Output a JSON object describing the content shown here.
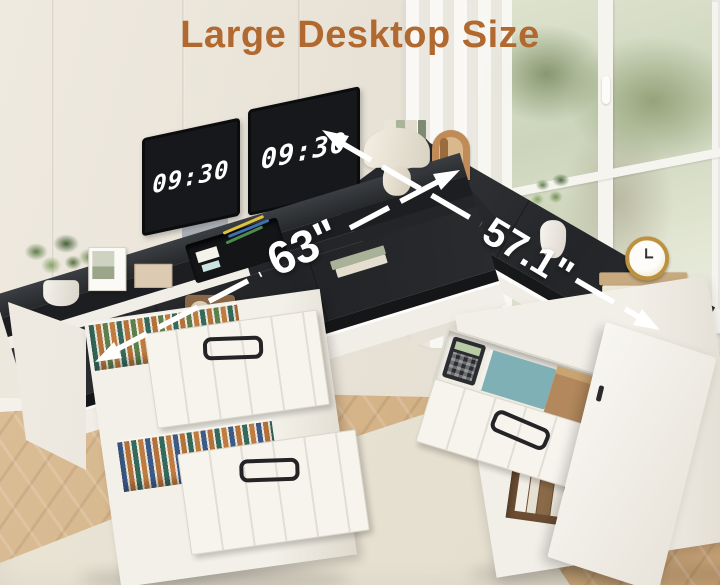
{
  "title": {
    "text": "Large Desktop Size"
  },
  "annotations": {
    "left_dimension": {
      "label": "63\""
    },
    "right_dimension": {
      "label": "57.1\""
    }
  },
  "monitors": {
    "left": {
      "clock": "09:30"
    },
    "right": {
      "clock": "09:30"
    }
  },
  "colors": {
    "accent": "#b2692f",
    "desk_top": "#27292c",
    "desk_body": "#f2efe9",
    "annotation": "#ffffff",
    "wall": "#e9e4d9",
    "floor": "#d5b489",
    "rug": "#e8e2d4",
    "foliage": "#5f7d4a"
  }
}
